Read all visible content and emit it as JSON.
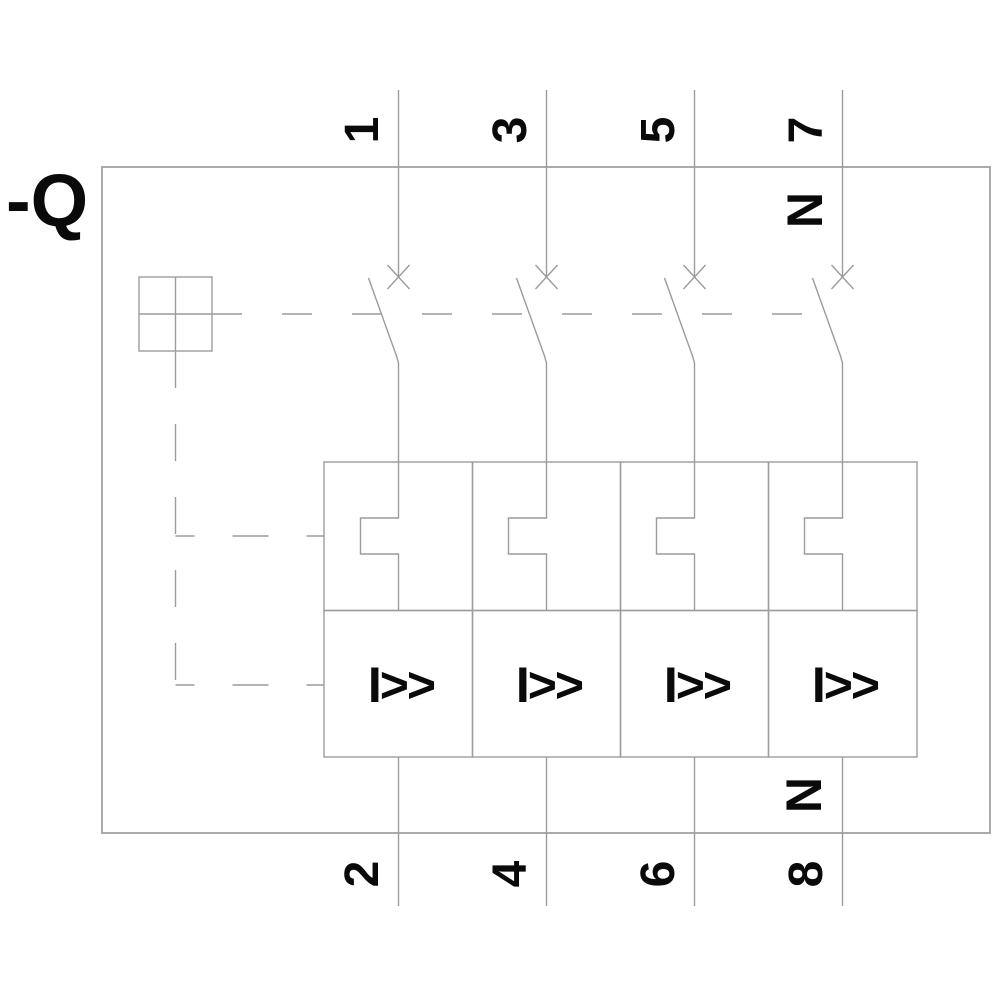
{
  "device": {
    "designation": "-Q"
  },
  "colors": {
    "line": "#9c9c9c",
    "text": "#0a0a0a",
    "background": "#ffffff"
  },
  "poles": [
    {
      "id": 1,
      "top_terminal": "1",
      "bottom_terminal": "2",
      "magnetic_trip": "I>>"
    },
    {
      "id": 2,
      "top_terminal": "3",
      "bottom_terminal": "4",
      "magnetic_trip": "I>>"
    },
    {
      "id": 3,
      "top_terminal": "5",
      "bottom_terminal": "6",
      "magnetic_trip": "I>>"
    },
    {
      "id": 4,
      "top_terminal": "7",
      "bottom_terminal": "8",
      "magnetic_trip": "I>>",
      "neutral_marker_top": "N",
      "neutral_marker_bottom": "N"
    }
  ]
}
